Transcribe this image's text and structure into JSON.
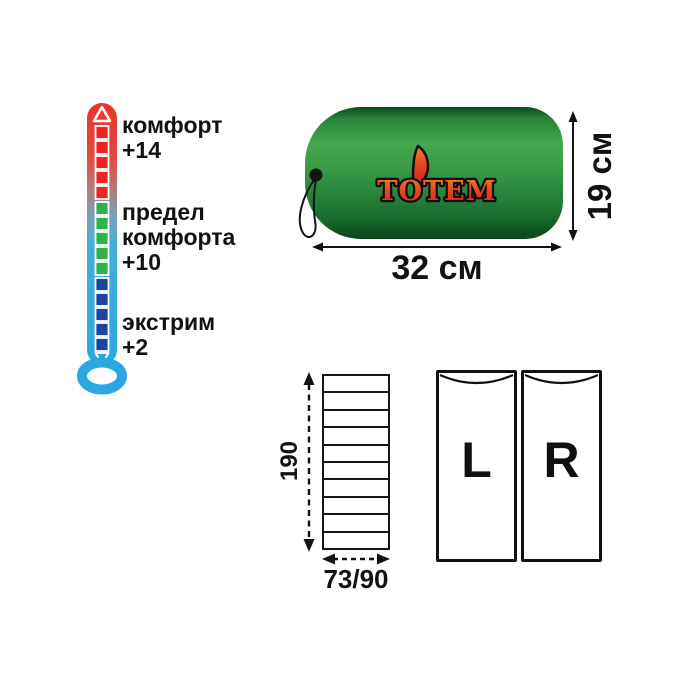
{
  "product": {
    "brand": "ТОТЕМ"
  },
  "thermometer": {
    "comfort": {
      "line1": "комфорт",
      "value": "+14"
    },
    "comfort_limit": {
      "line1": "предел",
      "line2": "комфорта",
      "value": "+10"
    },
    "extreme": {
      "line1": "экстрим",
      "value": "+2"
    },
    "scale_colors": {
      "warm": "#ee2424",
      "mild": "#2eb24c",
      "cold": "#1c469b",
      "tube_top": "#ea342e",
      "tube_bottom": "#29a8e2"
    }
  },
  "stuff_sack": {
    "width_label": "32 см",
    "height_label": "19 см",
    "logo_colors": {
      "fill_top": "#f08124",
      "fill_mid": "#e8431f",
      "fill_bottom": "#cf2a1e",
      "outline": "#140f0e"
    }
  },
  "unfolded": {
    "length_label": "190",
    "width_label": "73/90",
    "segments": 10
  },
  "zipper_options": {
    "left_label": "L",
    "right_label": "R"
  }
}
